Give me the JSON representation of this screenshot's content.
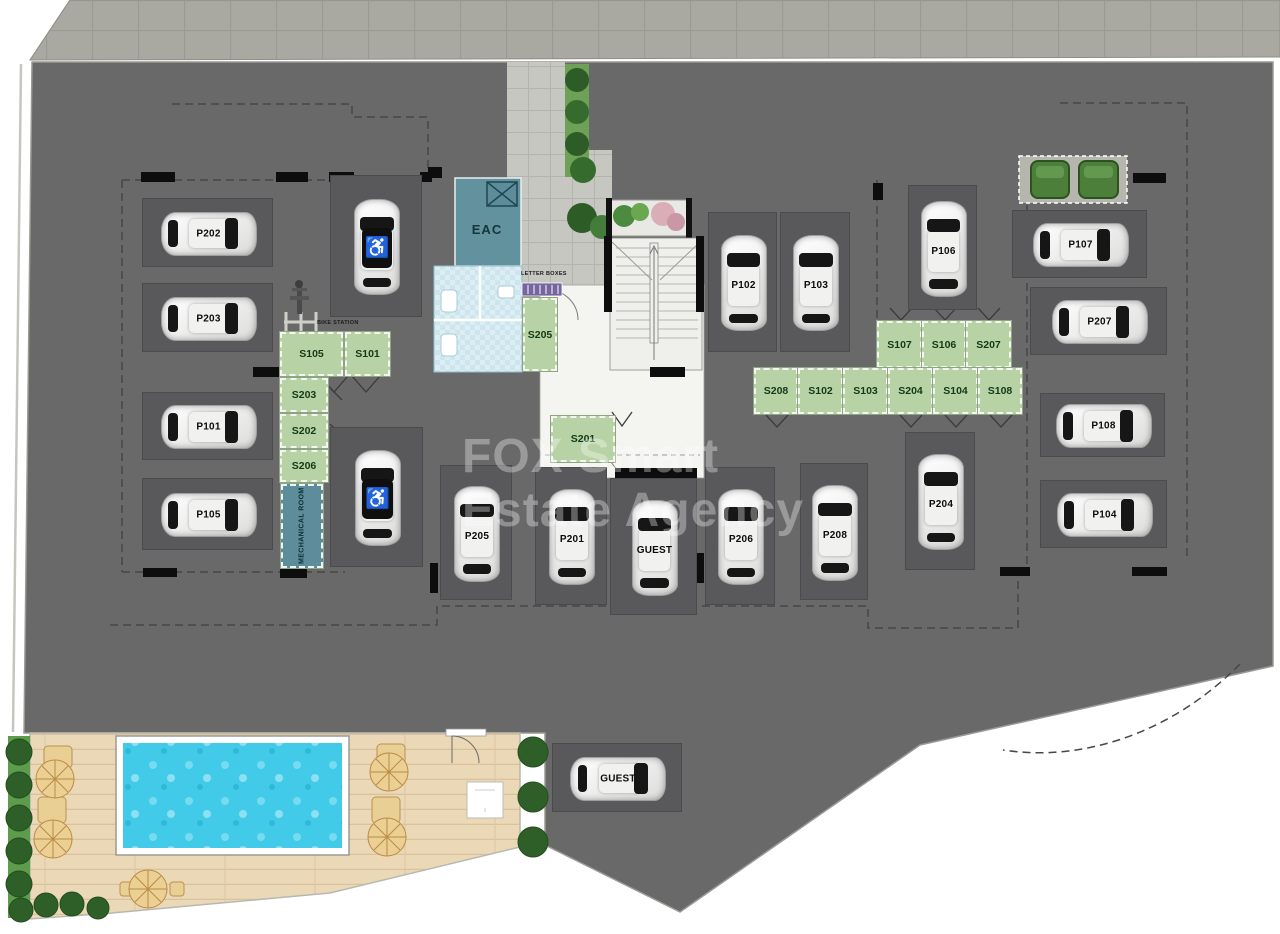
{
  "watermark": {
    "line1": "FOX Smart",
    "line2": "Estate Agency"
  },
  "rooms": {
    "eac": "EAC",
    "letter_boxes": "LETTER BOXES",
    "bike_station": "BIKE STATION"
  },
  "parking_spaces": [
    {
      "label": "P202",
      "x": 142,
      "y": 198,
      "w": 131,
      "h": 69,
      "dir": "h"
    },
    {
      "label": "P203",
      "x": 142,
      "y": 283,
      "w": 131,
      "h": 69,
      "dir": "h"
    },
    {
      "label": "P101",
      "x": 142,
      "y": 392,
      "w": 131,
      "h": 68,
      "dir": "h"
    },
    {
      "label": "P105",
      "x": 142,
      "y": 478,
      "w": 131,
      "h": 72,
      "dir": "h"
    },
    {
      "label": "",
      "type": "disabled",
      "x": 330,
      "y": 175,
      "w": 92,
      "h": 142,
      "dir": "v"
    },
    {
      "label": "",
      "type": "disabled",
      "x": 330,
      "y": 427,
      "w": 93,
      "h": 140,
      "dir": "v"
    },
    {
      "label": "P102",
      "x": 708,
      "y": 212,
      "w": 69,
      "h": 140,
      "dir": "v"
    },
    {
      "label": "P103",
      "x": 780,
      "y": 212,
      "w": 70,
      "h": 140,
      "dir": "v"
    },
    {
      "label": "P106",
      "x": 908,
      "y": 185,
      "w": 69,
      "h": 125,
      "dir": "v"
    },
    {
      "label": "P107",
      "x": 1012,
      "y": 210,
      "w": 135,
      "h": 68,
      "dir": "h"
    },
    {
      "label": "P207",
      "x": 1030,
      "y": 287,
      "w": 137,
      "h": 68,
      "dir": "h"
    },
    {
      "label": "P108",
      "x": 1040,
      "y": 393,
      "w": 125,
      "h": 64,
      "dir": "h"
    },
    {
      "label": "P104",
      "x": 1040,
      "y": 480,
      "w": 127,
      "h": 68,
      "dir": "h"
    },
    {
      "label": "P204",
      "x": 905,
      "y": 432,
      "w": 70,
      "h": 138,
      "dir": "v"
    },
    {
      "label": "P205",
      "x": 440,
      "y": 465,
      "w": 72,
      "h": 135,
      "dir": "v"
    },
    {
      "label": "P201",
      "x": 535,
      "y": 467,
      "w": 72,
      "h": 138,
      "dir": "v"
    },
    {
      "label": "GUEST",
      "x": 610,
      "y": 478,
      "w": 87,
      "h": 137,
      "dir": "v"
    },
    {
      "label": "P206",
      "x": 705,
      "y": 467,
      "w": 70,
      "h": 138,
      "dir": "v"
    },
    {
      "label": "P208",
      "x": 800,
      "y": 463,
      "w": 68,
      "h": 137,
      "dir": "v"
    },
    {
      "label": "GUEST",
      "x": 552,
      "y": 743,
      "w": 130,
      "h": 69,
      "dir": "h"
    }
  ],
  "storage_units": [
    {
      "label": "S105",
      "x": 280,
      "y": 332,
      "w": 63,
      "h": 44
    },
    {
      "label": "S101",
      "x": 345,
      "y": 332,
      "w": 45,
      "h": 44
    },
    {
      "label": "S203",
      "x": 280,
      "y": 378,
      "w": 48,
      "h": 34
    },
    {
      "label": "S202",
      "x": 280,
      "y": 414,
      "w": 48,
      "h": 34
    },
    {
      "label": "S206",
      "x": 280,
      "y": 450,
      "w": 48,
      "h": 32
    },
    {
      "label": "S205",
      "x": 523,
      "y": 298,
      "w": 34,
      "h": 73
    },
    {
      "label": "S201",
      "x": 551,
      "y": 416,
      "w": 64,
      "h": 46
    },
    {
      "label": "S107",
      "x": 877,
      "y": 321,
      "w": 45,
      "h": 47
    },
    {
      "label": "S106",
      "x": 922,
      "y": 321,
      "w": 44,
      "h": 47
    },
    {
      "label": "S207",
      "x": 966,
      "y": 321,
      "w": 45,
      "h": 47
    },
    {
      "label": "S208",
      "x": 754,
      "y": 368,
      "w": 44,
      "h": 46
    },
    {
      "label": "S102",
      "x": 798,
      "y": 368,
      "w": 45,
      "h": 46
    },
    {
      "label": "S103",
      "x": 843,
      "y": 368,
      "w": 45,
      "h": 46
    },
    {
      "label": "S204",
      "x": 888,
      "y": 368,
      "w": 45,
      "h": 46
    },
    {
      "label": "S104",
      "x": 933,
      "y": 368,
      "w": 45,
      "h": 46
    },
    {
      "label": "S108",
      "x": 978,
      "y": 368,
      "w": 44,
      "h": 46
    },
    {
      "label": "MECHANICAL ROOM",
      "type": "teal",
      "x": 281,
      "y": 484,
      "w": 42,
      "h": 84
    }
  ],
  "colors": {
    "floor": "#696969",
    "stall": "#59595b",
    "storage_green": "#b7d3a6",
    "utility_teal": "#5d8d9b",
    "pool_water": "#41cbe9",
    "deck_wood": "#ebd8b6",
    "hedge_green": "#3a6f33",
    "sidewalk": "#a9a8a1",
    "watermark": "rgba(255,255,255,0.33)"
  }
}
